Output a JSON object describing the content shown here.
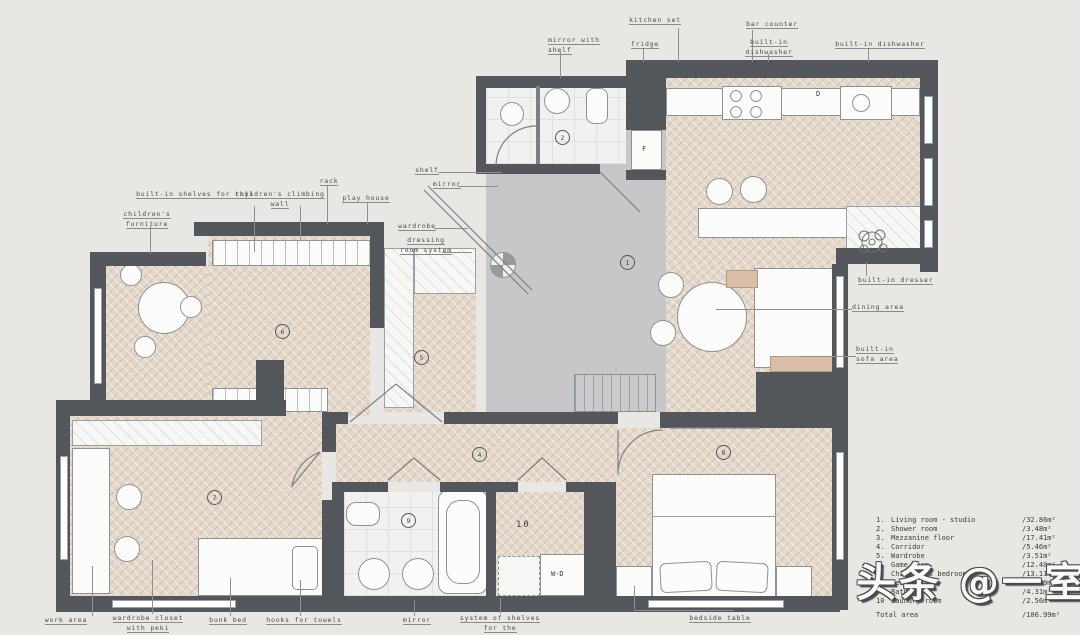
{
  "plan": {
    "labels": {
      "kitchen_set": "kitchen set",
      "fridge": "fridge",
      "bar_counter": "bar counter",
      "mirror_with_shelf": "mirror with shelf",
      "built_in_dishwasher_1": "built-in dishwasher",
      "built_in_dishwasher_2": "built-in dishwasher",
      "built_in_shelves_for_toys": "built-in shelves for toys",
      "childrens_climbing_wall": "children's climbing wall",
      "rack": "rack",
      "play_house": "play house",
      "childrens_furniture": "children's furniture",
      "shelf": "shelf",
      "mirror_top": "mirror",
      "wardrobe": "wardrobe",
      "dressing_room_system": "dressing room system",
      "built_in_dresser": "built-in dresser",
      "dining_area": "dining area",
      "built_in_sofa_area": "built-in sofa area",
      "work_area": "work area",
      "wardrobe_closet": "wardrobe closet with peki",
      "bunk_bed": "bunk bed",
      "hooks_for_towels": "hooks for towels",
      "mirror_bottom": "mirror",
      "system_of_shelves": "system of shelves for the",
      "bedside_table": "bedside table"
    },
    "tags": {
      "fridge": "F",
      "dishwasher": "D",
      "washer_dryer": "W-D"
    },
    "room_numbers": {
      "living": "1",
      "shower": "2",
      "corridor": "4",
      "wardrobe": "5",
      "game": "6",
      "children": "7",
      "bedroom": "8",
      "bathroom": "9",
      "laundry": "10"
    }
  },
  "legend": {
    "rows": [
      {
        "num": "1.",
        "name": "Living room - studio",
        "area": "/32.86m²"
      },
      {
        "num": "2.",
        "name": "Shower room",
        "area": "/3.48m²"
      },
      {
        "num": "3.",
        "name": "Mezzanine floor",
        "area": "/17.41m²"
      },
      {
        "num": "4.",
        "name": "Corridor",
        "area": "/5.46m²"
      },
      {
        "num": "5.",
        "name": "Wardrobe",
        "area": "/3.51m²"
      },
      {
        "num": "6.",
        "name": "Game room",
        "area": "/12.40m²"
      },
      {
        "num": "7.",
        "name": "Children's bedroom",
        "area": "/13.11m²"
      },
      {
        "num": "8.",
        "name": "Bedroom",
        "area": "/11.89m²"
      },
      {
        "num": "9.",
        "name": "Bathroom",
        "area": "/4.31m²"
      },
      {
        "num": "10",
        "name": "Laundry room",
        "area": "/2.56m²"
      }
    ],
    "total_label": "Total area",
    "total_value": "/106.99m²"
  },
  "watermark": "头条 @一室"
}
